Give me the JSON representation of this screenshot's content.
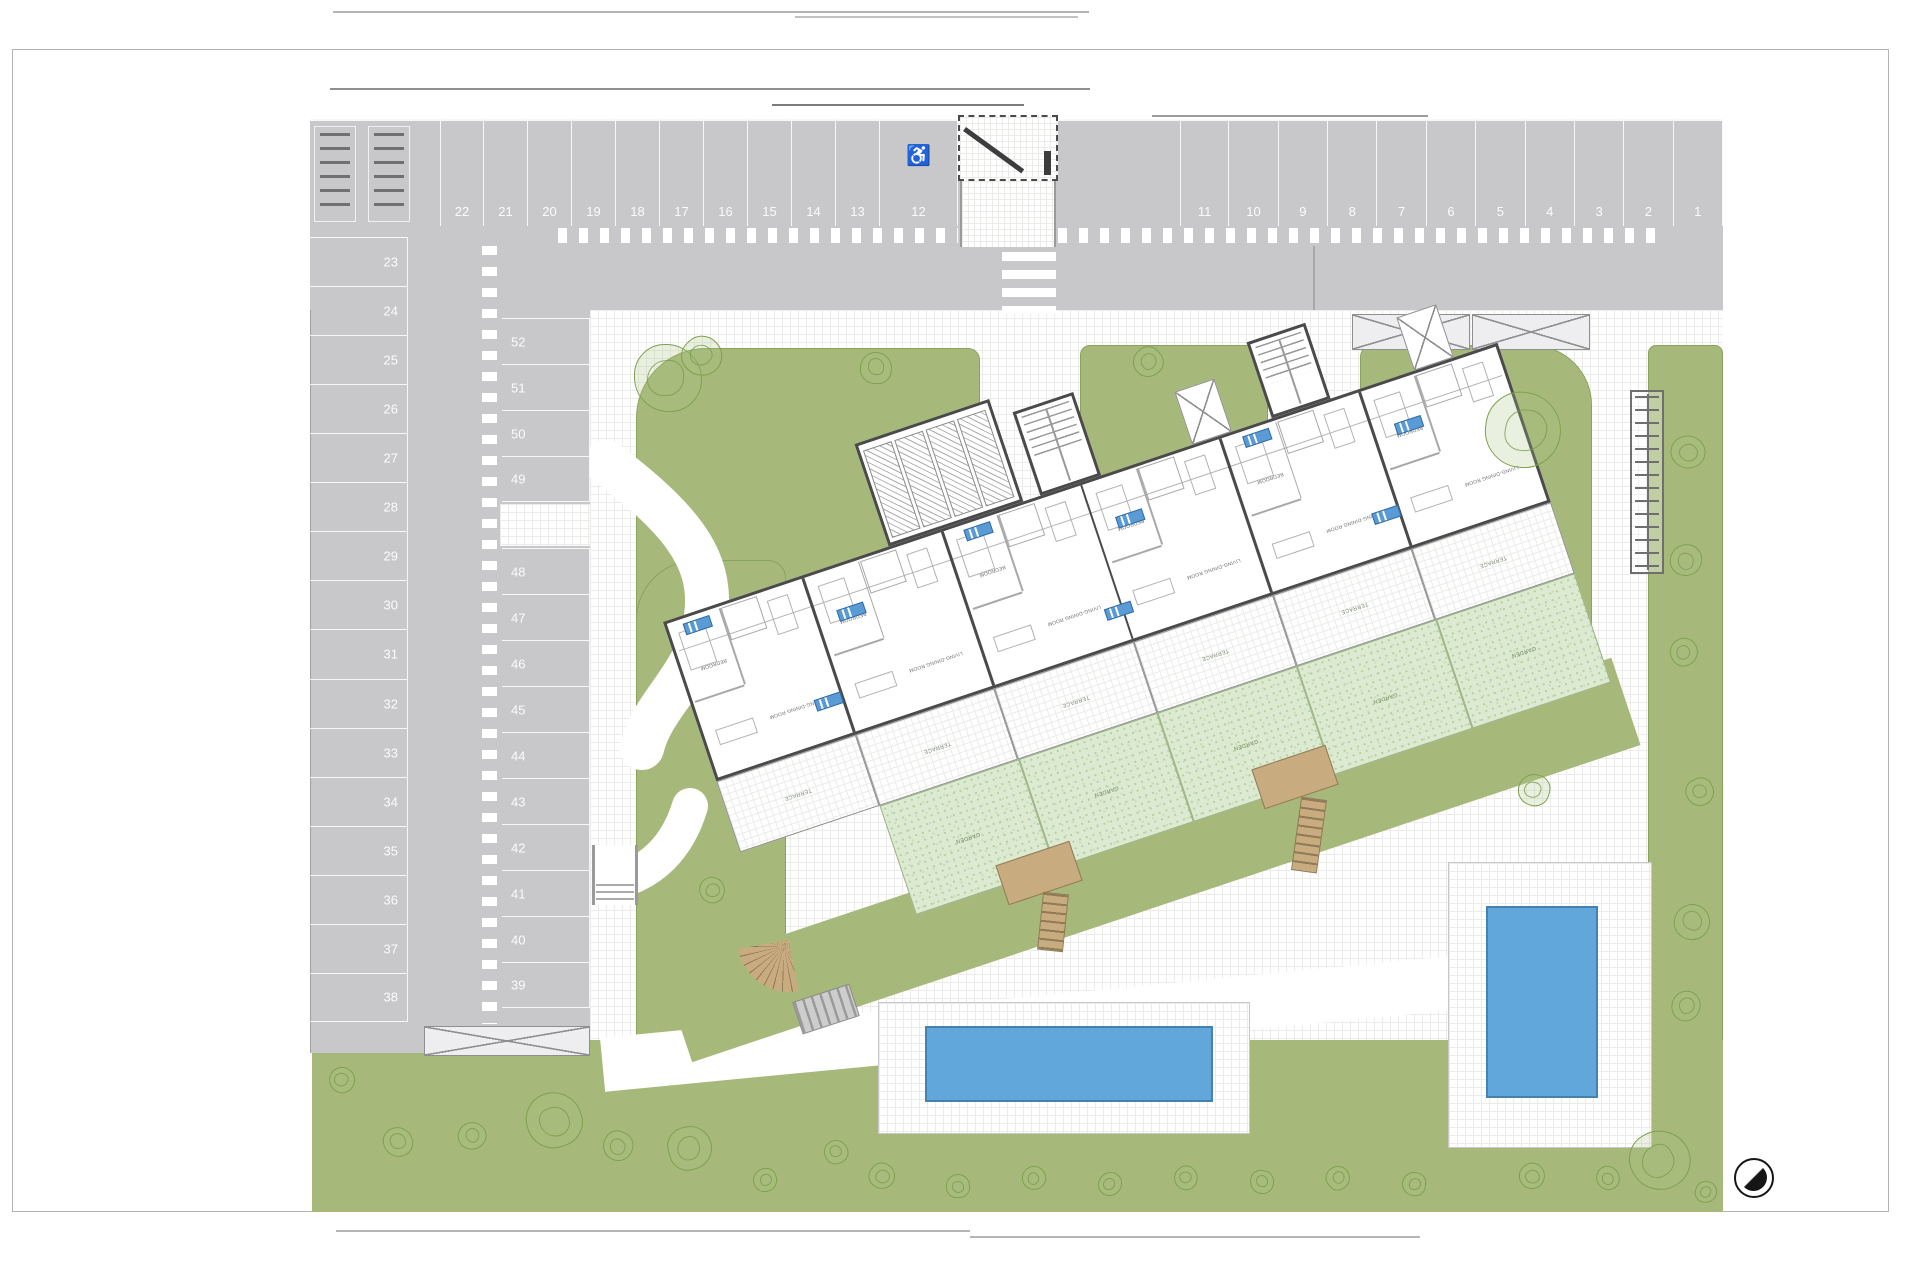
{
  "plan": {
    "icons": {
      "handicap": "♿",
      "compass": "compass-north-icon"
    },
    "parking": {
      "row_top_left": [
        "22",
        "21",
        "20",
        "19",
        "18",
        "17",
        "16",
        "15",
        "14",
        "13"
      ],
      "handicap_stall": "12",
      "row_top_right": [
        "11",
        "10",
        "9",
        "8",
        "7",
        "6",
        "5",
        "4",
        "3",
        "2",
        "1"
      ],
      "col_left": [
        "23",
        "24",
        "25",
        "26",
        "27",
        "28",
        "29",
        "30",
        "31",
        "32",
        "33",
        "34",
        "35",
        "36",
        "37",
        "38"
      ],
      "col_inner_upper": [
        "52",
        "51",
        "50",
        "49"
      ],
      "col_inner_lower": [
        "48",
        "47",
        "46",
        "45",
        "44",
        "43",
        "42",
        "41",
        "40",
        "39"
      ]
    },
    "building": {
      "unit_count": 6,
      "room_labels": {
        "bedroom": "BEDROOM",
        "living": "LIVING-DINING ROOM",
        "terrace": "TERRACE",
        "garden": "GARDEN"
      },
      "badges": [
        [
          18,
          8
        ],
        [
          168,
          44
        ],
        [
          314,
          8
        ],
        [
          462,
          44
        ],
        [
          608,
          8
        ],
        [
          756,
          44
        ],
        [
          118,
          122
        ],
        [
          422,
          128
        ],
        [
          706,
          122
        ]
      ]
    },
    "colors": {
      "parking_gray": "#c8c8ca",
      "lawn_green": "#a6b97b",
      "garden_green": "#dcead2",
      "pool_blue": "#62a7db",
      "deck_tan": "#c9ab80",
      "wall_dark": "#4a4a4a",
      "badge_blue": "#5b9bd5"
    },
    "trees": [
      [
        668,
        378,
        34
      ],
      [
        702,
        356,
        20
      ],
      [
        876,
        368,
        16
      ],
      [
        1148,
        362,
        15
      ],
      [
        1523,
        430,
        38
      ],
      [
        1688,
        452,
        17
      ],
      [
        1686,
        560,
        16
      ],
      [
        1684,
        652,
        14
      ],
      [
        1534,
        790,
        16
      ],
      [
        1700,
        792,
        14
      ],
      [
        1692,
        922,
        18
      ],
      [
        1686,
        1006,
        15
      ],
      [
        712,
        890,
        13
      ],
      [
        554,
        1120,
        28
      ],
      [
        618,
        1146,
        15
      ],
      [
        690,
        1148,
        22
      ],
      [
        342,
        1080,
        13
      ],
      [
        398,
        1142,
        15
      ],
      [
        472,
        1136,
        14
      ],
      [
        765,
        1180,
        12
      ],
      [
        882,
        1176,
        13
      ],
      [
        958,
        1186,
        12
      ],
      [
        1034,
        1178,
        12
      ],
      [
        1110,
        1184,
        12
      ],
      [
        1186,
        1178,
        12
      ],
      [
        1262,
        1182,
        12
      ],
      [
        1338,
        1178,
        12
      ],
      [
        1414,
        1184,
        12
      ],
      [
        1532,
        1176,
        13
      ],
      [
        1608,
        1178,
        12
      ],
      [
        1660,
        1160,
        30
      ],
      [
        1706,
        1192,
        11
      ],
      [
        836,
        1152,
        12
      ]
    ]
  }
}
